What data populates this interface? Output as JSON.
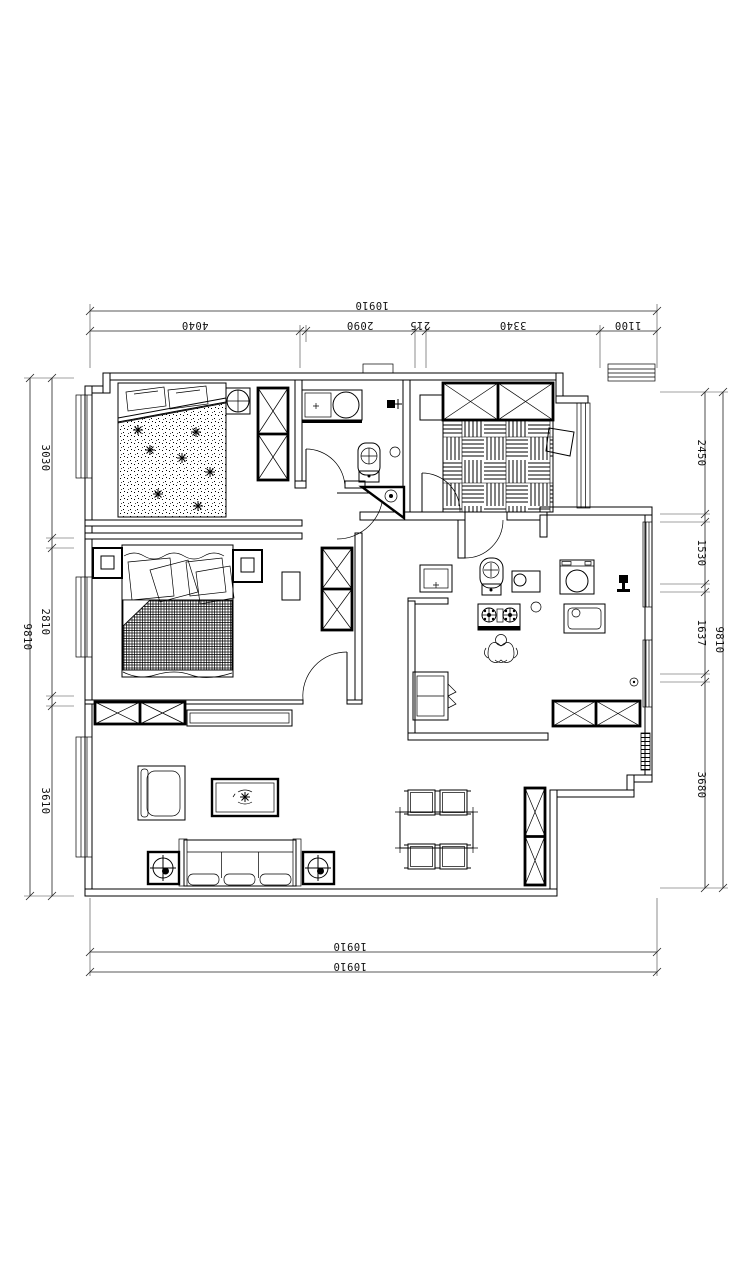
{
  "meta": {
    "drawing_type": "apartment floor plan (CAD)",
    "background": "#ffffff",
    "line_color": "#000000"
  },
  "dimensions": {
    "top": {
      "total": "10910",
      "segments": [
        "4040",
        "2090",
        "215",
        "3340",
        "1100"
      ]
    },
    "left": {
      "total": "9810",
      "segments": [
        "3030",
        "2810",
        "3610"
      ]
    },
    "right": {
      "total": "9810",
      "segments": [
        "2450",
        "1530",
        "1637",
        "3680"
      ]
    },
    "bottom": {
      "total_upper": "10910",
      "total_lower": "10910"
    }
  }
}
